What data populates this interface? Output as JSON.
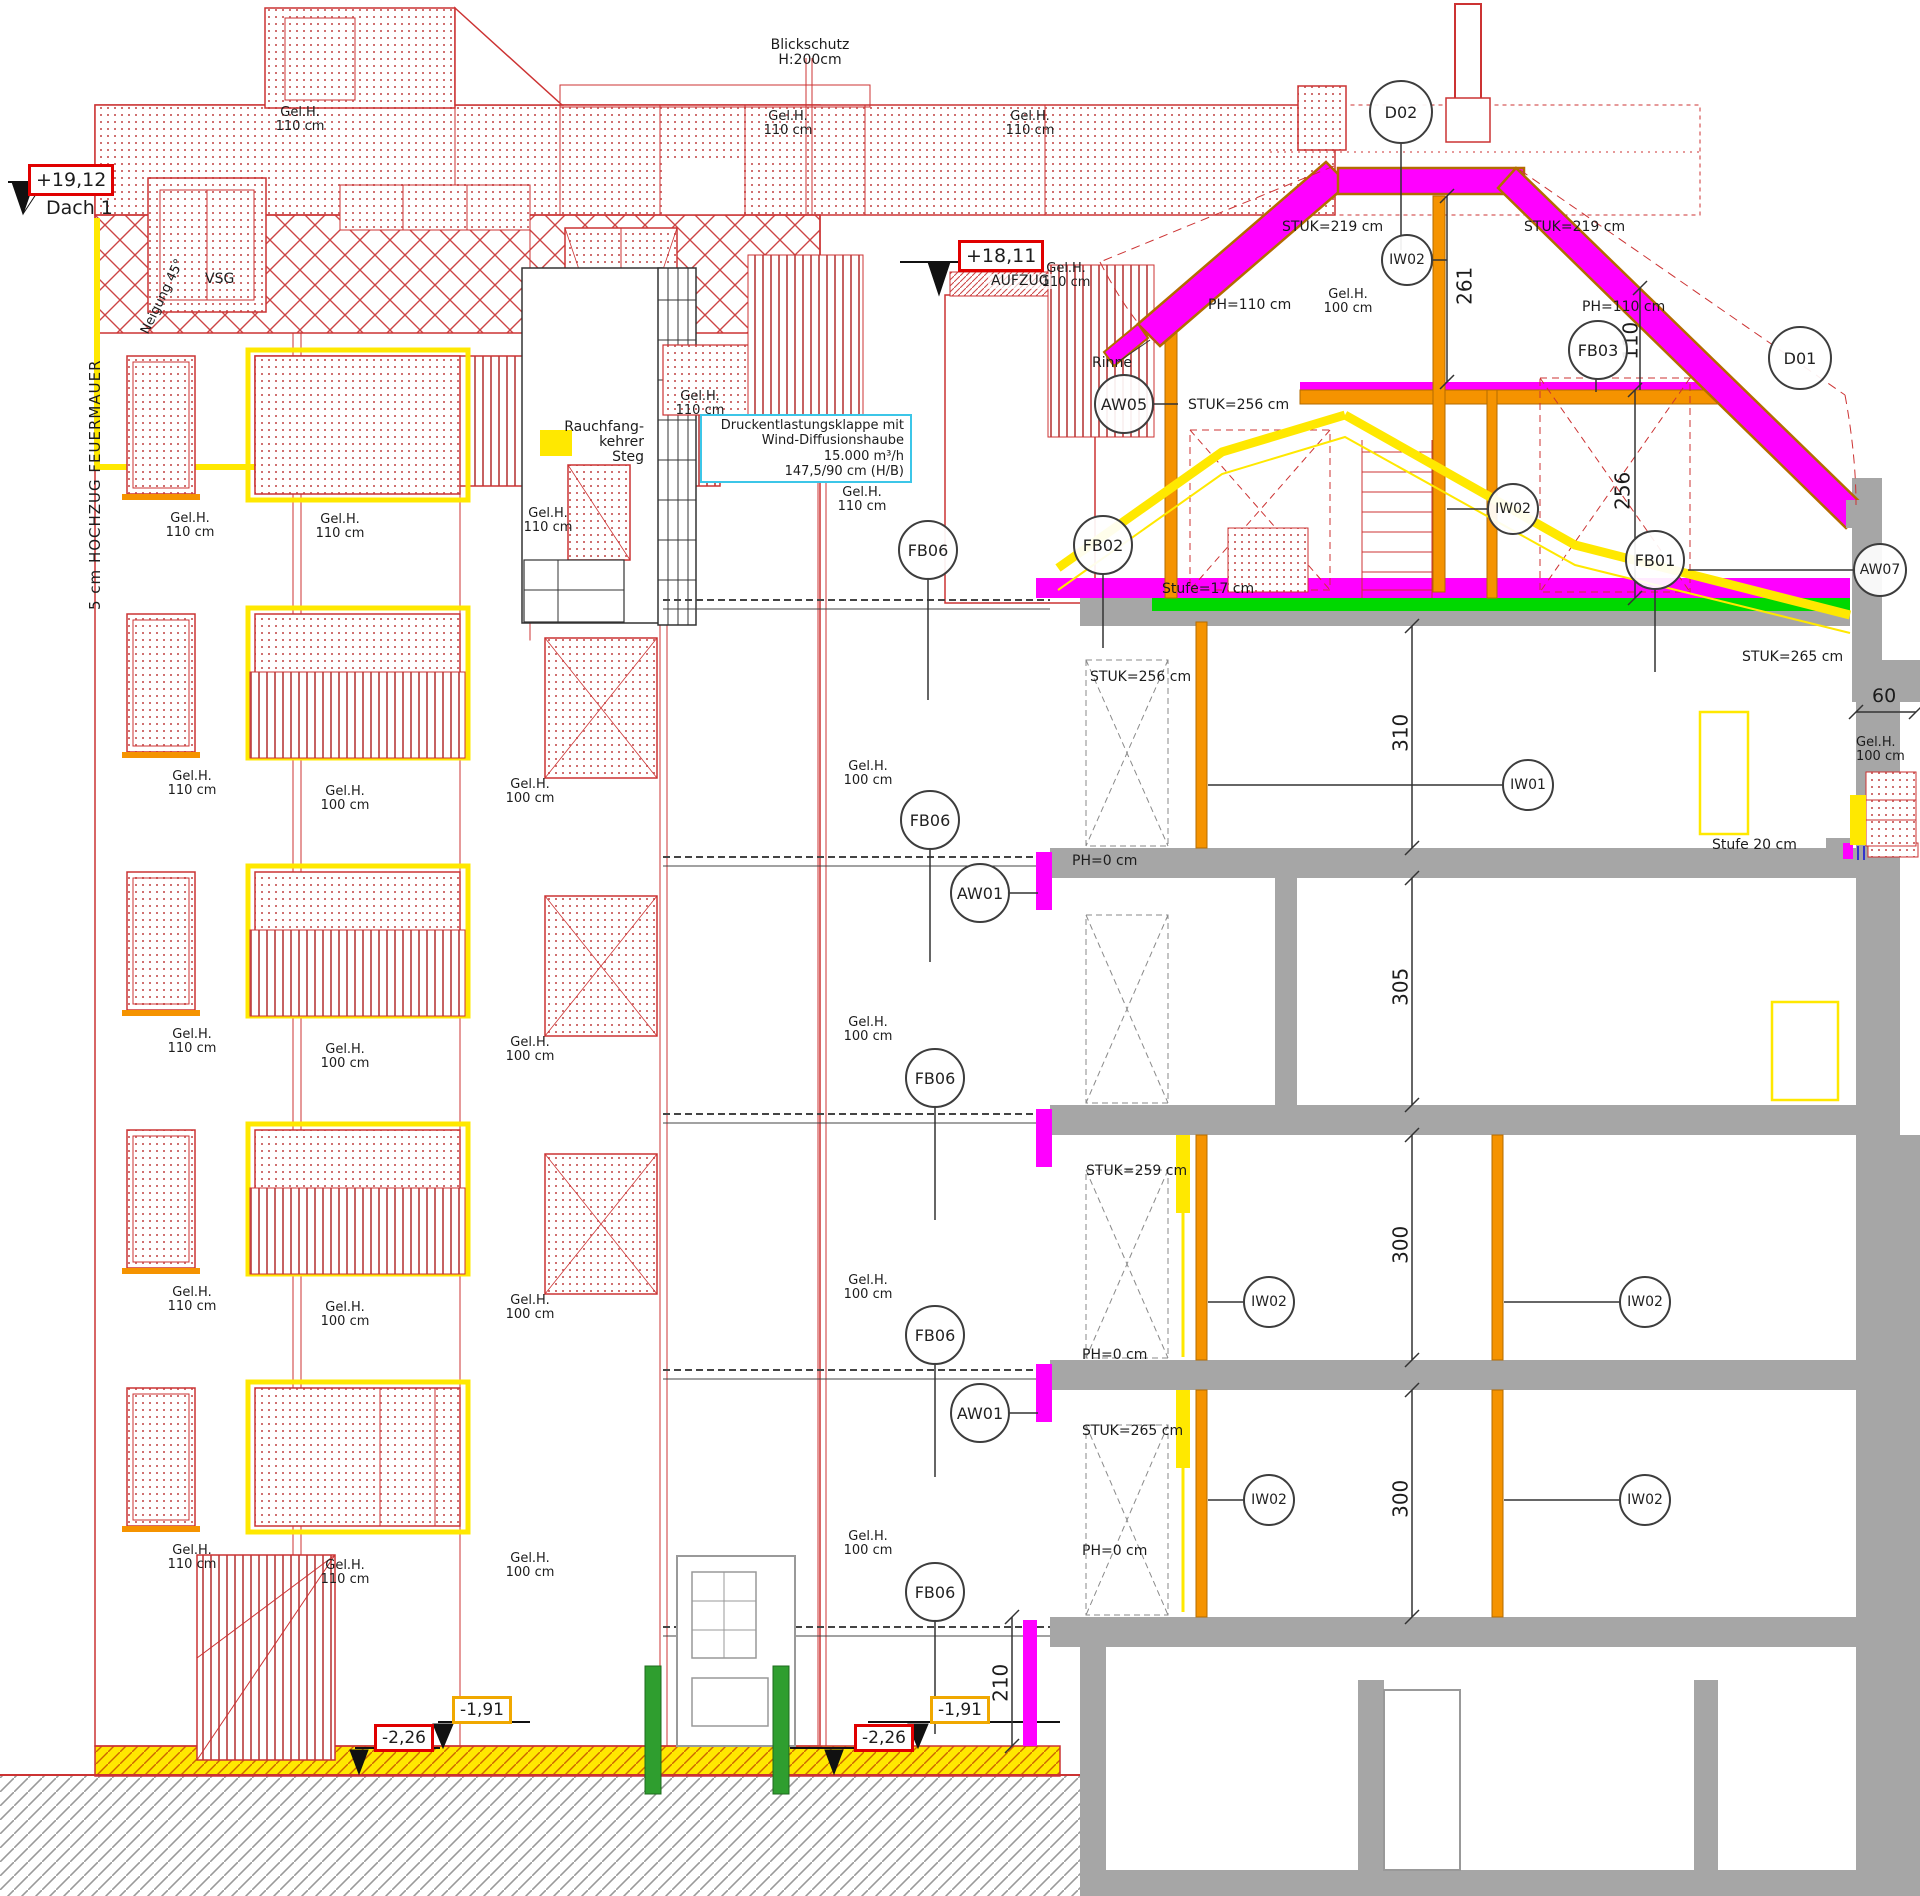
{
  "meta": {
    "drawing_type": "building cross-section and elevation, CAD plan"
  },
  "levels": {
    "dach_value": "+19,12",
    "dach_label": "Dach 1",
    "aufzug_value": "+18,11",
    "aufzug_label": "AUFZUG",
    "minus191": "-1,91",
    "minus226": "-2,26"
  },
  "callouts": {
    "d02": "D02",
    "d01": "D01",
    "fb01": "FB01",
    "fb02": "FB02",
    "fb03": "FB03",
    "fb06": "FB06",
    "aw01": "AW01",
    "aw05": "AW05",
    "aw07": "AW07",
    "iw01": "IW01",
    "iw02": "IW02"
  },
  "notes": {
    "blickschutz_line1": "Blickschutz",
    "blickschutz_line2": "H:200cm",
    "feuermauer": "5 cm HOCHZUG FEUERMAUER",
    "neigung": "Neigung 45°",
    "vsg": "VSG",
    "rauchfang_line1": "Rauchfang-",
    "rauchfang_line2": "kehrer",
    "rauchfang_line3": "Steg",
    "druck_line1": "Druckentlastungsklappe mit",
    "druck_line2": "Wind-Diffusionshaube",
    "druck_line3": "15.000 m³/h",
    "druck_line4": "147,5/90 cm (H/B)",
    "rinne": "Rinne",
    "gelh": "Gel.H.",
    "h110": "110 cm",
    "h100": "100 cm"
  },
  "params": {
    "stuk219": "STUK=219 cm",
    "stuk256": "STUK=256 cm",
    "stuk259": "STUK=259 cm",
    "stuk265": "STUK=265 cm",
    "ph110": "PH=110 cm",
    "ph0": "PH=0 cm",
    "stufe17": "Stufe=17 cm",
    "stufe20": "Stufe 20 cm"
  },
  "dimensions": {
    "d261": "261",
    "d256": "256",
    "d310": "310",
    "d305": "305",
    "d300": "300",
    "d110": "110",
    "d60": "60",
    "d210": "210"
  },
  "colors": {
    "line_red": "#cc3333",
    "magenta": "#ff00ff",
    "orange": "#f59300",
    "yellow": "#ffe800",
    "green_strip": "#00d800",
    "post_green": "#2f9e2f",
    "cyan": "#3cc6e8",
    "wall_gray": "#a6a6a6"
  }
}
